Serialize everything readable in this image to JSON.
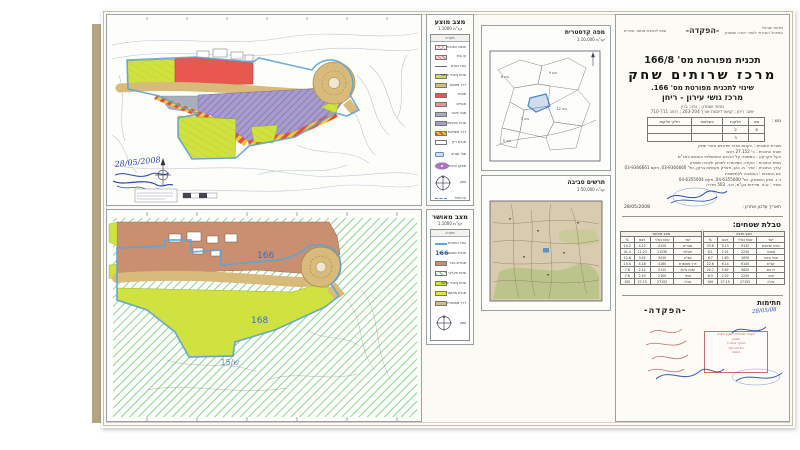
{
  "palette": {
    "lime": "#cfe23f",
    "red": "#e8584e",
    "salmon": "#f0938c",
    "purple": "#a79ccb",
    "tan": "#d8ba7a",
    "brown": "#c98f70",
    "grayblue": "#a8aebd",
    "boundary_blue": "#5ea4d4",
    "hatch_green": "#7bd07b",
    "ink_blue": "#2848b0",
    "stamp_red": "#c05050"
  },
  "proposed": {
    "title": "מצב מוצע",
    "scale": "קנ\"מ 1:1000",
    "legend_header": "מקרא",
    "items": [
      {
        "label": "תחום התכנית",
        "color": "pink-crosshatch"
      },
      {
        "label": "קו בנין",
        "color": "pink-hatch"
      },
      {
        "label": "גבול מגרש",
        "color": "line"
      },
      {
        "label": "שטח ציבורי פתוח",
        "color": "#cfe23f"
      },
      {
        "label": "דרך מוצעת",
        "color": "#d8ba7a"
      },
      {
        "label": "מסחר",
        "color": "#e8584e"
      },
      {
        "label": "מגורים",
        "color": "#f0938c"
      },
      {
        "label": "מבני ציבור",
        "color": "#a8aebd"
      },
      {
        "label": "מרכז שרותים",
        "color": "#a79ccb"
      },
      {
        "label": "דרך משולבת",
        "color": "red-yellow-stripes"
      },
      {
        "label": "מגרש ריק",
        "color": "#ffffff"
      }
    ],
    "symbols": {
      "chip_label": "מס' מגרש",
      "ellipse_label": "מתקן הנדסי",
      "compass_label": "צפון",
      "dash_label": "קו כחול"
    },
    "handwritten_date": "28/05/2008"
  },
  "approved": {
    "title": "מצב מאושר",
    "scale": "קנ\"מ 1:1000",
    "legend_header": "מקרא",
    "items": [
      {
        "label": "גבול התכנית",
        "color": "blue-line"
      },
      {
        "label": "תכנית מאושרת מס'",
        "color": "text-166",
        "value": "166"
      },
      {
        "label": "מגורים כפר",
        "color": "#c98f70"
      },
      {
        "label": "שטח חקלאי",
        "color": "green-hatch"
      },
      {
        "label": "שטח ציבורי פתוח",
        "color": "#cfe23f"
      },
      {
        "label": "מגרש מאושר",
        "color": "#e6e23e"
      },
      {
        "label": "דרך מאושרת",
        "color": "#d8ba7a"
      }
    ],
    "labels": {
      "plan166": "166",
      "plan168": "168",
      "out": "ש/15"
    },
    "compass_label": "צפון"
  },
  "cadastral": {
    "title": "מפה קדסטרית",
    "scale": "קנ\"מ 1:10,000",
    "blocks": [
      "גוש 8",
      "גוש 9",
      "גוש 3",
      "גוש 12",
      "גוש 5"
    ]
  },
  "env": {
    "title": "תרשים סביבה",
    "scale": "קנ\"מ 1:50,000"
  },
  "titleblock": {
    "header": {
      "left": "שינוי לתכנית מתאר אזורית",
      "center": "-הפקדה-",
      "right1": "מדינת ישראל",
      "right2": "המינהל האזרחי לאזור יהודה ושומרון"
    },
    "plan_no": "תכנית מפורטת מס' 166/8",
    "plan_name": "מרכז שרותים שחק",
    "amendment": "שינוי לתכנית מפורטת מס' 166.",
    "locality": "מרכז גושי עירון - ריחן",
    "sub1": "מחוז: שומרון ; נפה: ג'נין",
    "sub2": "ישוב: ריחן ; קואורדינטות אורך 203-204 ; רוחב 710-711",
    "parcels_label": "גוש :",
    "parcels_head": [
      [
        "גוש",
        "חלקות",
        "בשלמות",
        "חלקי חלקות"
      ]
    ],
    "parcels_rows": [
      [
        "8",
        "2",
        "",
        ""
      ],
      [
        "",
        "3",
        "",
        ""
      ]
    ],
    "details": [
      "מטרת התכנית : הקמת מרכז שרותים אזורי שחק",
      "שטח התכנית : כ- 27.152 דונם",
      "בעל הקרקע : הממונה על הרכוש הממשלתי והנטוש באיו\"ש",
      "מגיש התכנית : הועדה המיוחדת לתכנון ולבניה שומרון",
      "עורך התכנית : אדר' מ. כהן, פארק תעשיות ברקן, טל' 03-9366660, פקס 03-9366661",
      "יזם התכנית : החטיבה להתישבות",
      "ד.נ. צפון השומרון, טל' 04-6355000, פקס 04-6355004",
      "מודד : א.פ. מדידות בע\"מ, ת.ד. 503 חדרה"
    ],
    "update_label": "תאריך עדכון אחרון :",
    "update_date": "28/05/2008",
    "areas_title": "טבלת שטחים:",
    "areas_proposed": {
      "caption": "מצב מוצע",
      "head": [
        [
          "יעוד",
          "שטח במ\"ר",
          "דונם",
          "%"
        ]
      ],
      "rows": [
        [
          "מרכז שרותים",
          "9132",
          "9.13",
          "33.6"
        ],
        [
          "מסחר",
          "2210",
          "2.21",
          "8.1"
        ],
        [
          "מבני ציבור",
          "1830",
          "1.83",
          "6.7"
        ],
        [
          "שצ\"פ",
          "6140",
          "6.14",
          "22.6"
        ],
        [
          "דרכים",
          "5620",
          "5.62",
          "20.7"
        ],
        [
          "חניה",
          "2220",
          "2.22",
          "8.3"
        ],
        [
          "סה\"כ",
          "27152",
          "27.15",
          "100"
        ]
      ]
    },
    "areas_approved": {
      "caption": "מצב מאושר",
      "head": [
        [
          "יעוד",
          "שטח במ\"ר",
          "דונם",
          "%"
        ]
      ],
      "rows": [
        [
          "מגורים",
          "4120",
          "4.12",
          "15.2"
        ],
        [
          "חקלאי",
          "11230",
          "11.23",
          "41.4"
        ],
        [
          "שצ\"פ",
          "3410",
          "3.41",
          "12.6"
        ],
        [
          "דרך מאושרת",
          "4180",
          "4.18",
          "15.4"
        ],
        [
          "שטח גלעין",
          "2112",
          "2.11",
          "7.8"
        ],
        [
          "אחר",
          "2100",
          "2.10",
          "7.6"
        ],
        [
          "סה\"כ",
          "27152",
          "27.15",
          "100"
        ]
      ]
    },
    "signatures": {
      "header": "חתימות",
      "deposit": "-הפקדה-",
      "hand_date": "28/05/08",
      "stamp_lines": [
        "הועדה המיוחדת לתכנון ולבניה",
        "שומרון",
        "הופקד בתאריך",
        "החלטה מס'",
        "חתימה"
      ]
    }
  }
}
